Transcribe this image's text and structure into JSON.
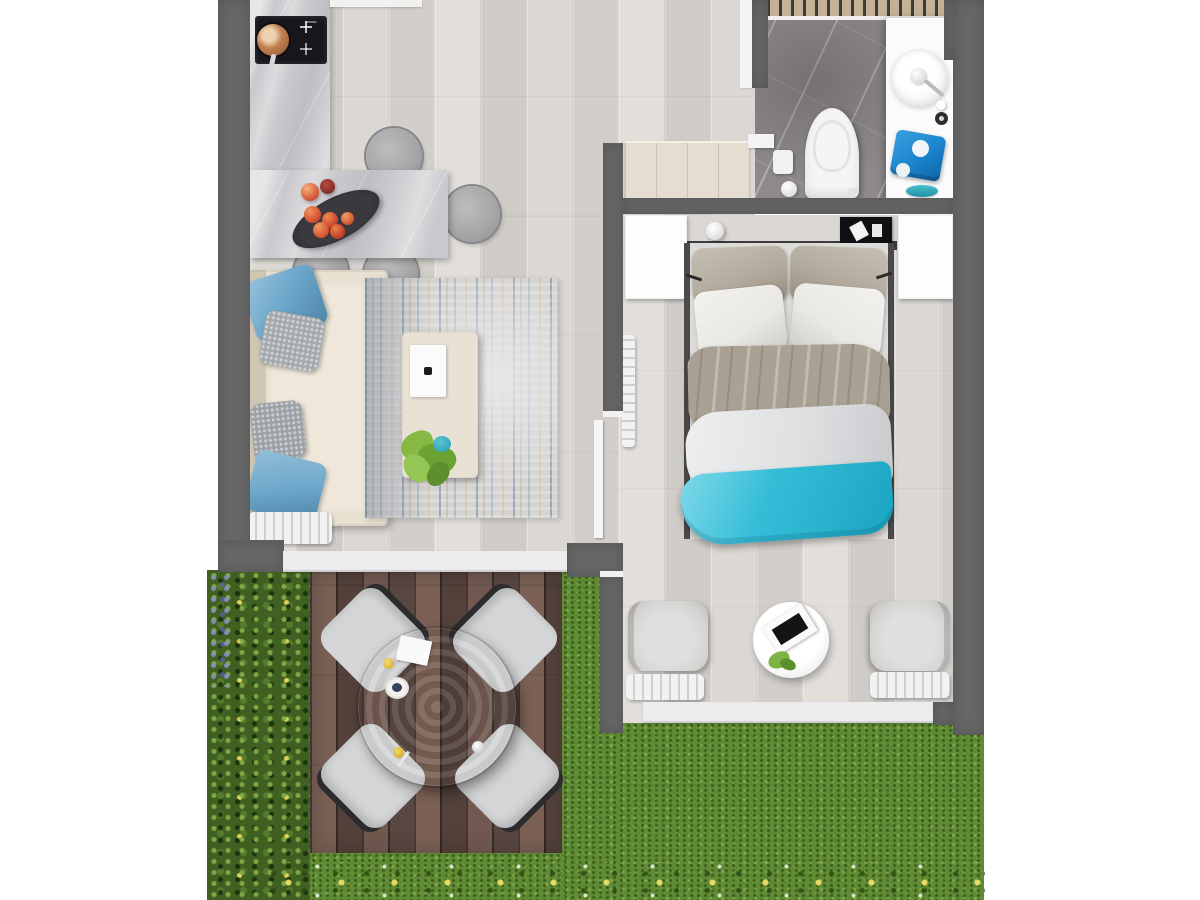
{
  "title": "apartment-floor-plan-top-view-render",
  "palette": {
    "bg": "#ffffff",
    "wall": "#676767",
    "floor": "#d8d5d1",
    "floor_dark": "#cfccc7",
    "floor_light": "#e2dfdb",
    "marble": "#c9c9cd",
    "stove": "#17171d",
    "copper": "#c08050",
    "chair_gray": "#a4a4a6",
    "sofa": "#e8e0d0",
    "pillow_blue": "#6fa9cb",
    "pillow_knit": "#a3a8ad",
    "rug": "#d6d4d2",
    "table_cream": "#e9e2d4",
    "tray": "#fbfbfb",
    "plant": "#7cb342",
    "teal_dish": "#2fa8ba",
    "deck": "#66514a",
    "deck_dark": "#53413a",
    "deck_light": "#7a6055",
    "patio_table": "#bdac94",
    "patio_cushion": "#d4d5d6",
    "patio_frame": "#2c2c2e",
    "hedge": "#3f6020",
    "flower_yellow": "#ead95a",
    "lavender": "#8a8fc4",
    "grass": "#628e35",
    "bath_floor": "#8e8a8c",
    "porcelain": "#f5f5f7",
    "vanity": "#fbfbfc",
    "towel_blue": "#1a84cd",
    "chrome": "#b9bcc0",
    "slats": "#c5b295",
    "bed_sheet": "#dcdbd8",
    "pillow_taupe": "#b2ab9e",
    "pillow_white": "#e9e8e5",
    "blanket": "#a9a193",
    "duvet": "#dfe0e2",
    "teal_blanket": "#35bdd8",
    "nightstand": "#fdfdfd",
    "headboard": "#3c3c40",
    "shelf": "#dbd8d4",
    "radiator": "#f2f2f2",
    "threshold": "#ececee",
    "door": "#e4ddd0"
  },
  "scene": {
    "type": "photoreal top-down floor plan of a one-bedroom apartment with patio and garden",
    "rooms": [
      {
        "name": "kitchen-dining",
        "items": [
          "marble-counter",
          "cooktop",
          "copper-pan",
          "marble-dining-table",
          "dining-chair-top",
          "dining-chair-right",
          "dining-chair-bottom-1",
          "dining-chair-bottom-2",
          "fruit-bowl",
          "loose-fruits"
        ]
      },
      {
        "name": "living-room",
        "items": [
          "sofa",
          "blue-pillow-1",
          "knit-pillow-1",
          "knit-pillow-2",
          "blue-pillow-2",
          "area-rug",
          "coffee-table",
          "serving-tray",
          "houseplant",
          "radiator"
        ]
      },
      {
        "name": "hallway",
        "items": [
          "entry-door"
        ]
      },
      {
        "name": "bathroom",
        "items": [
          "shower-slats",
          "toilet",
          "toilet-paper-holder",
          "vanity",
          "round-sink",
          "soap-dispenser",
          "faucet",
          "drain",
          "blue-towel",
          "teal-dish"
        ]
      },
      {
        "name": "bedroom",
        "items": [
          "headboard-shelf",
          "table-lamp",
          "wall-art",
          "nightstand-left",
          "nightstand-right",
          "double-bed",
          "taupe-pillows",
          "white-pillows",
          "gray-blanket",
          "white-duvet",
          "teal-throw",
          "wall-radiator",
          "armchair-left",
          "armchair-right",
          "round-side-table",
          "magazine",
          "sprig",
          "radiator-left",
          "radiator-right"
        ]
      },
      {
        "name": "patio",
        "items": [
          "wood-deck",
          "round-dining-table",
          "patio-chair-nw",
          "patio-chair-ne",
          "patio-chair-sw",
          "patio-chair-se",
          "menu-card",
          "plate-with-berries",
          "drink-cups",
          "glass"
        ]
      },
      {
        "name": "garden",
        "items": [
          "hedge",
          "lavender-patch",
          "lawn",
          "flower-border"
        ]
      }
    ]
  }
}
